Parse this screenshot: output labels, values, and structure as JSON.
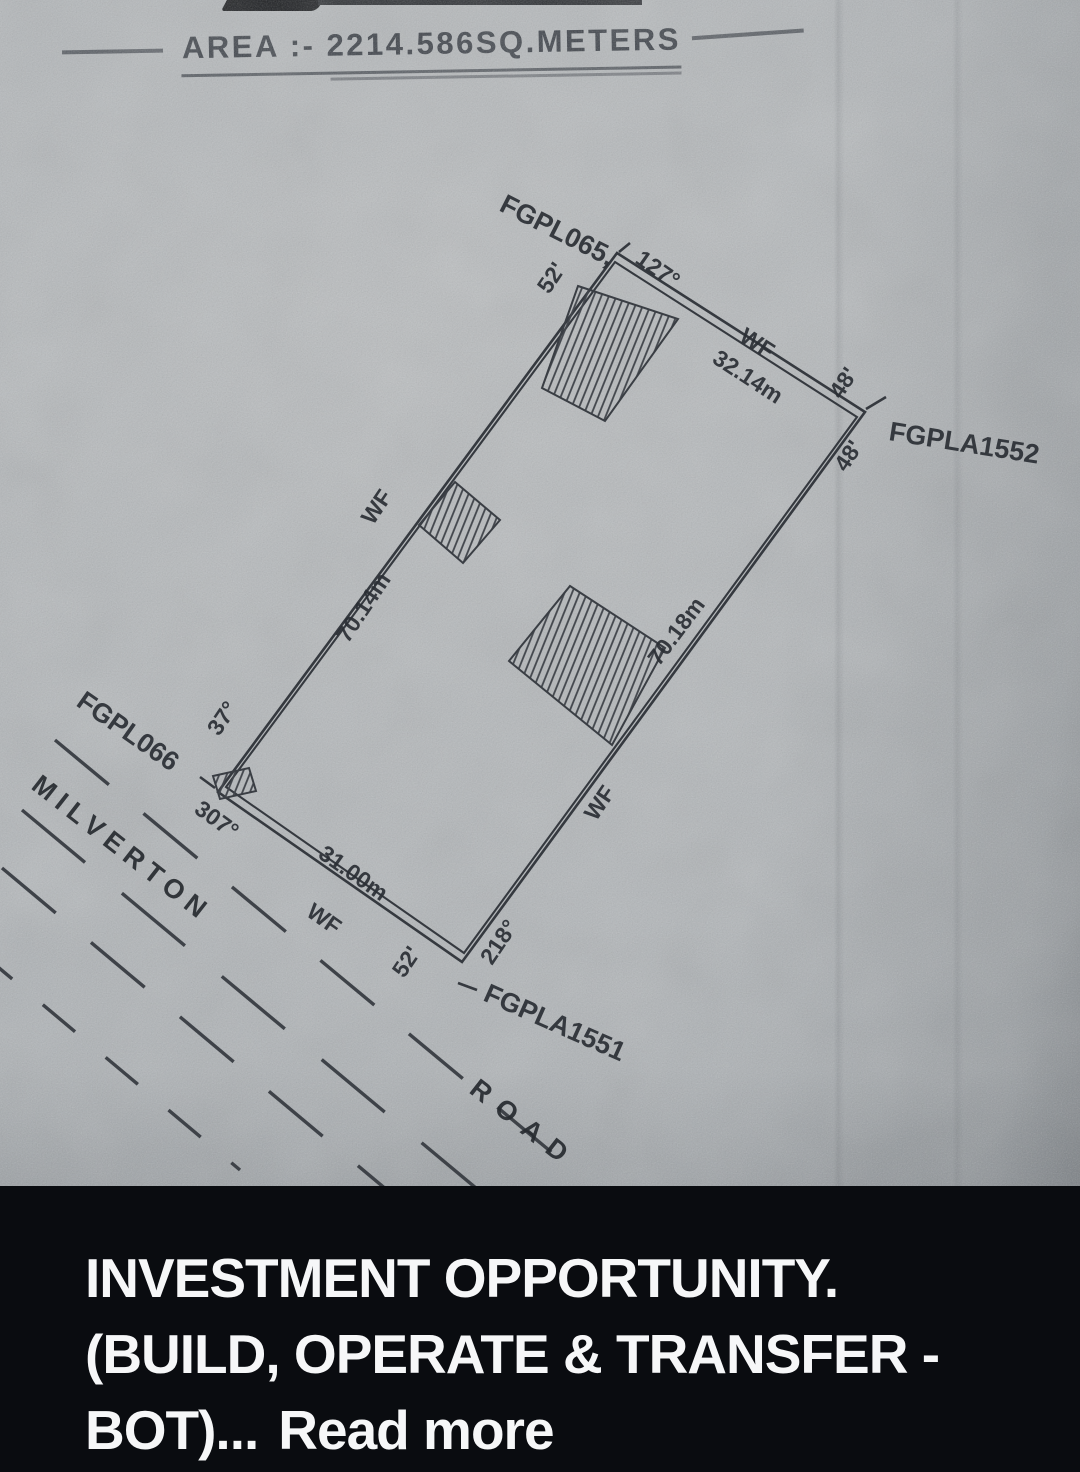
{
  "plan": {
    "area_title": "AREA :- 2214.586SQ.METERS",
    "parcel_top": "FGPL065,",
    "bearing_top": "127°",
    "width_top": "52'",
    "wf_top": "WF",
    "length_top": "32.14m",
    "offset_upper_right": "48'",
    "parcel_right": "FGPLA1552",
    "offset_lower_right": "48'",
    "wf_left": "WF",
    "length_left": "70.14m",
    "bearing_left": "37°",
    "parcel_left": "FGPL066",
    "bearing_bottom_left": "307°",
    "length_bottom": "31.00m",
    "wf_bottom": "WF",
    "width_bottom": "52'",
    "bearing_bottom_right": "218°",
    "parcel_bottom": "FGPLA1551",
    "wf_right": "WF",
    "length_right": "70.18m",
    "road_name_first": "MILVERTON",
    "road_name_second": "ROAD"
  },
  "caption": {
    "line1": "INVESTMENT OPPORTUNITY.",
    "line2": "(BUILD, OPERATE & TRANSFER -",
    "line3": "BOT)...",
    "read_more": "Read more"
  },
  "colors": {
    "caption_background": "#0a0c10",
    "caption_text": "#f6f7f8",
    "paper": "#b2b6b9",
    "ink": "#34383e"
  }
}
